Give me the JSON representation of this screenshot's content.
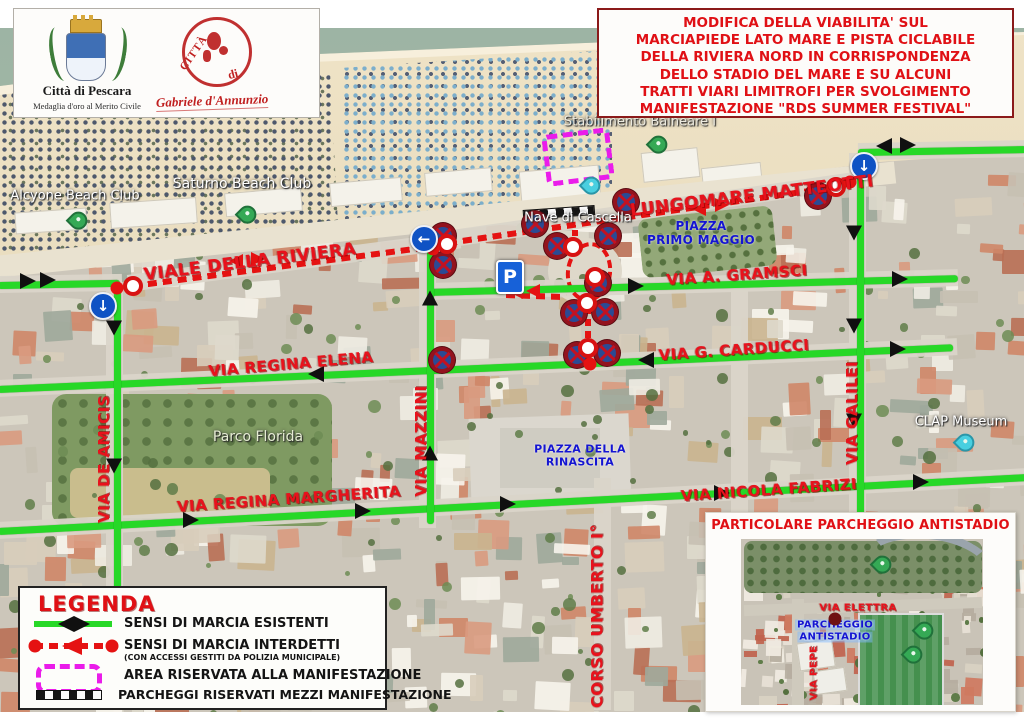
{
  "logo_box": {
    "crest_title": "Città di Pescara",
    "crest_subtitle": "Medaglia d'oro al Merito Civile",
    "stamp_citta": "CITTÀ",
    "stamp_di": "di",
    "stamp_signature": "Gabriele d'Annunzio"
  },
  "title_box": {
    "lines": [
      "MODIFICA DELLA VIABILITA' SUL",
      "MARCIAPIEDE LATO MARE E PISTA CICLABILE",
      "DELLA RIVIERA NORD IN CORRISPONDENZA",
      "DELLO STADIO DEL MARE E SU ALCUNI",
      "TRATTI VIARI LIMITROFI PER SVOLGIMENTO",
      "MANIFESTAZIONE \"RDS SUMMER FESTIVAL\""
    ]
  },
  "streets": {
    "riviera": "VIALE DELLA RIVIERA",
    "lungomare": "LUNGOMARE MATTEOTTI",
    "gramsci": "VIA A. GRAMSCI",
    "carducci": "VIA G. CARDUCCI",
    "elena": "VIA REGINA ELENA",
    "margherita": "VIA REGINA MARGHERITA",
    "fabrizi": "VIA NICOLA FABRIZI",
    "deamicis": "VIA DE AMICIS",
    "mazzini": "VIA MAZZINI",
    "galilei": "VIA GALILEI",
    "umberto": "CORSO UMBERTO I°"
  },
  "places": {
    "alcyone": "Alcyone Beach Club",
    "saturno": "Saturno Beach Club",
    "stabilimento": "Stabilimento Balneare I",
    "nave": "Nave di Cascella",
    "parco": "Parco Florida",
    "clap": "CLAP Museum",
    "piazza_primo_1": "PIAZZA",
    "piazza_primo_2": "PRIMO MAGGIO",
    "piazza_rin_1": "PIAZZA DELLA",
    "piazza_rin_2": "RINASCITA"
  },
  "signs": {
    "parking": "P"
  },
  "legend": {
    "title": "LEGENDA",
    "items": [
      {
        "label": "SENSI DI MARCIA ESISTENTI"
      },
      {
        "label": "SENSI DI MARCIA INTERDETTI",
        "sub": "(CON ACCESSI GESTITI DA POLIZIA MUNICIPALE)"
      },
      {
        "label": "AREA RISERVATA ALLA MANIFESTAZIONE"
      },
      {
        "label": "PARCHEGGI RISERVATI MEZZI MANIFESTAZIONE"
      }
    ]
  },
  "inset": {
    "title": "PARTICOLARE PARCHEGGIO ANTISTADIO",
    "elettra": "VIA ELETTRA",
    "parcheggio_1": "PARCHEGGIO",
    "parcheggio_2": "ANTISTADIO",
    "pepe": "VIA PEPE"
  },
  "colors": {
    "existing_direction_green": "#27d827",
    "interdicted_red": "#e51212",
    "reserved_area_magenta": "#ea1cea",
    "street_label_red": "#e8121c",
    "piazza_label_blue": "#1414d2",
    "title_red": "#e01015"
  },
  "markers": {
    "no_stopping_signs": [
      [
        443,
        208
      ],
      [
        443,
        237
      ],
      [
        535,
        196
      ],
      [
        557,
        218
      ],
      [
        608,
        208
      ],
      [
        626,
        174
      ],
      [
        818,
        168
      ],
      [
        598,
        255
      ],
      [
        574,
        285
      ],
      [
        605,
        284
      ],
      [
        577,
        327
      ],
      [
        607,
        325
      ],
      [
        442,
        332
      ]
    ],
    "checkpoint_circles": [
      [
        133,
        258
      ],
      [
        447,
        216
      ],
      [
        836,
        159
      ],
      [
        573,
        219
      ],
      [
        595,
        249
      ],
      [
        587,
        275
      ],
      [
        588,
        320
      ]
    ],
    "closure_dots": [
      [
        117,
        260
      ],
      [
        433,
        221
      ],
      [
        850,
        154
      ],
      [
        590,
        336
      ]
    ],
    "one_way_signs": [
      {
        "x": 103,
        "y": 278,
        "dir": "down"
      },
      {
        "x": 424,
        "y": 211,
        "dir": "left"
      },
      {
        "x": 864,
        "y": 138,
        "dir": "down"
      }
    ],
    "pins_green": [
      [
        72,
        199
      ],
      [
        241,
        193
      ],
      [
        652,
        123
      ]
    ],
    "pins_cyan": [
      [
        585,
        164
      ],
      [
        959,
        421
      ]
    ],
    "inset_pins_green": [
      [
        170,
        58
      ],
      [
        212,
        124
      ],
      [
        201,
        148
      ]
    ],
    "inset_closure_dot": [
      129,
      106
    ]
  }
}
